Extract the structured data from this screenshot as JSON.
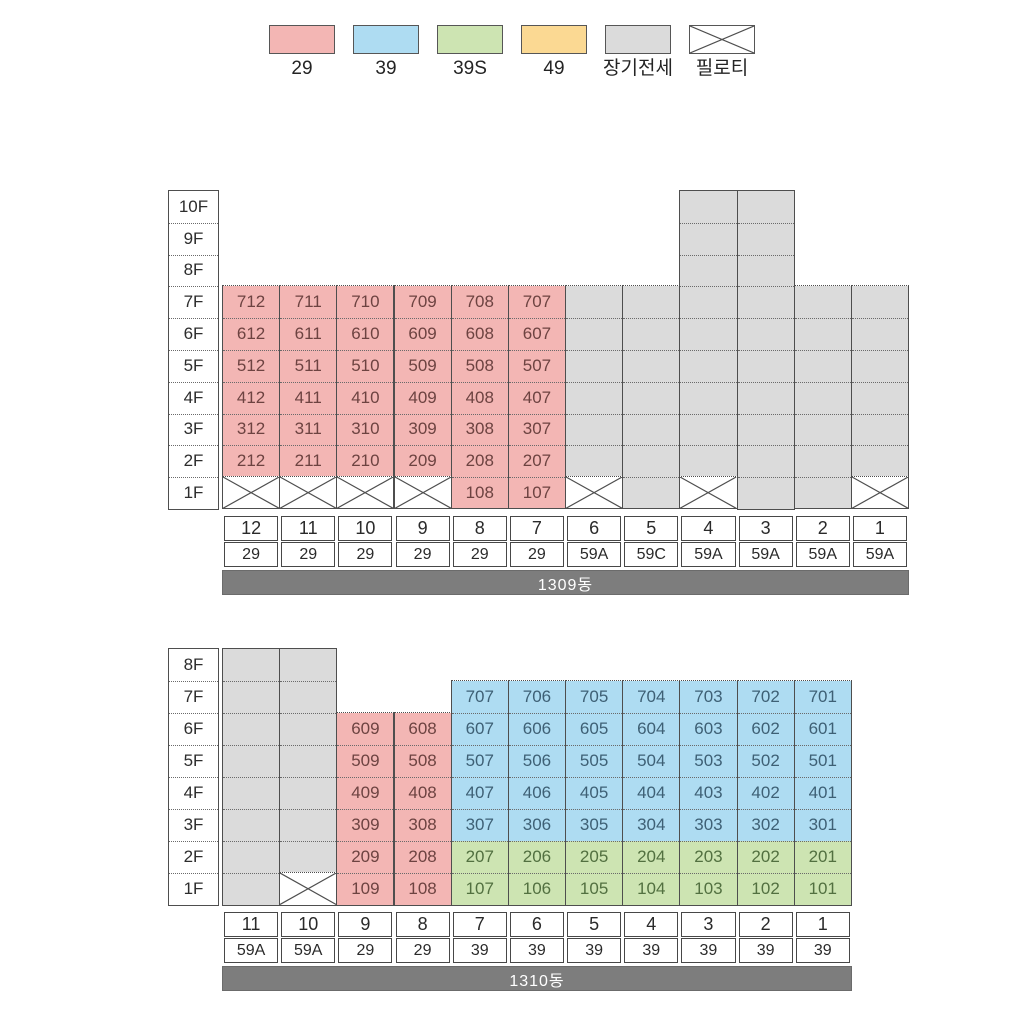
{
  "legend": {
    "items": [
      {
        "label": "29",
        "type": "29"
      },
      {
        "label": "39",
        "type": "39"
      },
      {
        "label": "39S",
        "type": "39S"
      },
      {
        "label": "49",
        "type": "49"
      },
      {
        "label": "장기전세",
        "type": "장기전세"
      },
      {
        "label": "필로티",
        "type": "필로티"
      }
    ]
  },
  "palette": {
    "fill": {
      "29": "#f3b6b4",
      "39": "#aedcf2",
      "39S": "#cde4b2",
      "49": "#fbd993",
      "장기전세": "#dbdbdb"
    },
    "text": {
      "29": "#6d4341",
      "39": "#3e6075",
      "39S": "#527040"
    },
    "pilotis_bg": "#ffffff",
    "border": "#4e4e4e",
    "bar_bg": "#7d7d7d",
    "bar_text": "#ffffff"
  },
  "cell_format": [
    "floor",
    "unit",
    "type"
  ],
  "buildings": [
    {
      "name": "1309동",
      "floors": [
        "10F",
        "9F",
        "8F",
        "7F",
        "6F",
        "5F",
        "4F",
        "3F",
        "2F",
        "1F"
      ],
      "columns": [
        {
          "line": "12",
          "unit_type": "29",
          "cells": [
            [
              "7F",
              "712",
              "29"
            ],
            [
              "6F",
              "612",
              "29"
            ],
            [
              "5F",
              "512",
              "29"
            ],
            [
              "4F",
              "412",
              "29"
            ],
            [
              "3F",
              "312",
              "29"
            ],
            [
              "2F",
              "212",
              "29"
            ],
            [
              "1F",
              "",
              "필로티"
            ]
          ]
        },
        {
          "line": "11",
          "unit_type": "29",
          "cells": [
            [
              "7F",
              "711",
              "29"
            ],
            [
              "6F",
              "611",
              "29"
            ],
            [
              "5F",
              "511",
              "29"
            ],
            [
              "4F",
              "411",
              "29"
            ],
            [
              "3F",
              "311",
              "29"
            ],
            [
              "2F",
              "211",
              "29"
            ],
            [
              "1F",
              "",
              "필로티"
            ]
          ]
        },
        {
          "line": "10",
          "unit_type": "29",
          "cells": [
            [
              "7F",
              "710",
              "29"
            ],
            [
              "6F",
              "610",
              "29"
            ],
            [
              "5F",
              "510",
              "29"
            ],
            [
              "4F",
              "410",
              "29"
            ],
            [
              "3F",
              "310",
              "29"
            ],
            [
              "2F",
              "210",
              "29"
            ],
            [
              "1F",
              "",
              "필로티"
            ]
          ]
        },
        {
          "line": "9",
          "unit_type": "29",
          "cells": [
            [
              "7F",
              "709",
              "29"
            ],
            [
              "6F",
              "609",
              "29"
            ],
            [
              "5F",
              "509",
              "29"
            ],
            [
              "4F",
              "409",
              "29"
            ],
            [
              "3F",
              "309",
              "29"
            ],
            [
              "2F",
              "209",
              "29"
            ],
            [
              "1F",
              "",
              "필로티"
            ]
          ]
        },
        {
          "line": "8",
          "unit_type": "29",
          "cells": [
            [
              "7F",
              "708",
              "29"
            ],
            [
              "6F",
              "608",
              "29"
            ],
            [
              "5F",
              "508",
              "29"
            ],
            [
              "4F",
              "408",
              "29"
            ],
            [
              "3F",
              "308",
              "29"
            ],
            [
              "2F",
              "208",
              "29"
            ],
            [
              "1F",
              "108",
              "29"
            ]
          ]
        },
        {
          "line": "7",
          "unit_type": "29",
          "cells": [
            [
              "7F",
              "707",
              "29"
            ],
            [
              "6F",
              "607",
              "29"
            ],
            [
              "5F",
              "507",
              "29"
            ],
            [
              "4F",
              "407",
              "29"
            ],
            [
              "3F",
              "307",
              "29"
            ],
            [
              "2F",
              "207",
              "29"
            ],
            [
              "1F",
              "107",
              "29"
            ]
          ]
        },
        {
          "line": "6",
          "unit_type": "59A",
          "cells": [
            [
              "7F",
              "",
              "장기전세"
            ],
            [
              "6F",
              "",
              "장기전세"
            ],
            [
              "5F",
              "",
              "장기전세"
            ],
            [
              "4F",
              "",
              "장기전세"
            ],
            [
              "3F",
              "",
              "장기전세"
            ],
            [
              "2F",
              "",
              "장기전세"
            ],
            [
              "1F",
              "",
              "필로티"
            ]
          ]
        },
        {
          "line": "5",
          "unit_type": "59C",
          "cells": [
            [
              "7F",
              "",
              "장기전세"
            ],
            [
              "6F",
              "",
              "장기전세"
            ],
            [
              "5F",
              "",
              "장기전세"
            ],
            [
              "4F",
              "",
              "장기전세"
            ],
            [
              "3F",
              "",
              "장기전세"
            ],
            [
              "2F",
              "",
              "장기전세"
            ],
            [
              "1F",
              "",
              "장기전세"
            ]
          ]
        },
        {
          "line": "4",
          "unit_type": "59A",
          "cells": [
            [
              "10F",
              "",
              "장기전세"
            ],
            [
              "9F",
              "",
              "장기전세"
            ],
            [
              "8F",
              "",
              "장기전세"
            ],
            [
              "7F",
              "",
              "장기전세"
            ],
            [
              "6F",
              "",
              "장기전세"
            ],
            [
              "5F",
              "",
              "장기전세"
            ],
            [
              "4F",
              "",
              "장기전세"
            ],
            [
              "3F",
              "",
              "장기전세"
            ],
            [
              "2F",
              "",
              "장기전세"
            ],
            [
              "1F",
              "",
              "필로티"
            ]
          ]
        },
        {
          "line": "3",
          "unit_type": "59A",
          "cells": [
            [
              "10F",
              "",
              "장기전세"
            ],
            [
              "9F",
              "",
              "장기전세"
            ],
            [
              "8F",
              "",
              "장기전세"
            ],
            [
              "7F",
              "",
              "장기전세"
            ],
            [
              "6F",
              "",
              "장기전세"
            ],
            [
              "5F",
              "",
              "장기전세"
            ],
            [
              "4F",
              "",
              "장기전세"
            ],
            [
              "3F",
              "",
              "장기전세"
            ],
            [
              "2F",
              "",
              "장기전세"
            ],
            [
              "1F",
              "",
              "장기전세"
            ]
          ]
        },
        {
          "line": "2",
          "unit_type": "59A",
          "cells": [
            [
              "7F",
              "",
              "장기전세"
            ],
            [
              "6F",
              "",
              "장기전세"
            ],
            [
              "5F",
              "",
              "장기전세"
            ],
            [
              "4F",
              "",
              "장기전세"
            ],
            [
              "3F",
              "",
              "장기전세"
            ],
            [
              "2F",
              "",
              "장기전세"
            ],
            [
              "1F",
              "",
              "장기전세"
            ]
          ]
        },
        {
          "line": "1",
          "unit_type": "59A",
          "cells": [
            [
              "7F",
              "",
              "장기전세"
            ],
            [
              "6F",
              "",
              "장기전세"
            ],
            [
              "5F",
              "",
              "장기전세"
            ],
            [
              "4F",
              "",
              "장기전세"
            ],
            [
              "3F",
              "",
              "장기전세"
            ],
            [
              "2F",
              "",
              "장기전세"
            ],
            [
              "1F",
              "",
              "필로티"
            ]
          ]
        }
      ]
    },
    {
      "name": "1310동",
      "floors": [
        "8F",
        "7F",
        "6F",
        "5F",
        "4F",
        "3F",
        "2F",
        "1F"
      ],
      "columns": [
        {
          "line": "11",
          "unit_type": "59A",
          "cells": [
            [
              "8F",
              "",
              "장기전세"
            ],
            [
              "7F",
              "",
              "장기전세"
            ],
            [
              "6F",
              "",
              "장기전세"
            ],
            [
              "5F",
              "",
              "장기전세"
            ],
            [
              "4F",
              "",
              "장기전세"
            ],
            [
              "3F",
              "",
              "장기전세"
            ],
            [
              "2F",
              "",
              "장기전세"
            ],
            [
              "1F",
              "",
              "장기전세"
            ]
          ]
        },
        {
          "line": "10",
          "unit_type": "59A",
          "cells": [
            [
              "8F",
              "",
              "장기전세"
            ],
            [
              "7F",
              "",
              "장기전세"
            ],
            [
              "6F",
              "",
              "장기전세"
            ],
            [
              "5F",
              "",
              "장기전세"
            ],
            [
              "4F",
              "",
              "장기전세"
            ],
            [
              "3F",
              "",
              "장기전세"
            ],
            [
              "2F",
              "",
              "장기전세"
            ],
            [
              "1F",
              "",
              "필로티"
            ]
          ]
        },
        {
          "line": "9",
          "unit_type": "29",
          "cells": [
            [
              "6F",
              "609",
              "29"
            ],
            [
              "5F",
              "509",
              "29"
            ],
            [
              "4F",
              "409",
              "29"
            ],
            [
              "3F",
              "309",
              "29"
            ],
            [
              "2F",
              "209",
              "29"
            ],
            [
              "1F",
              "109",
              "29"
            ]
          ]
        },
        {
          "line": "8",
          "unit_type": "29",
          "cells": [
            [
              "6F",
              "608",
              "29"
            ],
            [
              "5F",
              "508",
              "29"
            ],
            [
              "4F",
              "408",
              "29"
            ],
            [
              "3F",
              "308",
              "29"
            ],
            [
              "2F",
              "208",
              "29"
            ],
            [
              "1F",
              "108",
              "29"
            ]
          ]
        },
        {
          "line": "7",
          "unit_type": "39",
          "cells": [
            [
              "7F",
              "707",
              "39"
            ],
            [
              "6F",
              "607",
              "39"
            ],
            [
              "5F",
              "507",
              "39"
            ],
            [
              "4F",
              "407",
              "39"
            ],
            [
              "3F",
              "307",
              "39"
            ],
            [
              "2F",
              "207",
              "39S"
            ],
            [
              "1F",
              "107",
              "39S"
            ]
          ]
        },
        {
          "line": "6",
          "unit_type": "39",
          "cells": [
            [
              "7F",
              "706",
              "39"
            ],
            [
              "6F",
              "606",
              "39"
            ],
            [
              "5F",
              "506",
              "39"
            ],
            [
              "4F",
              "406",
              "39"
            ],
            [
              "3F",
              "306",
              "39"
            ],
            [
              "2F",
              "206",
              "39S"
            ],
            [
              "1F",
              "106",
              "39S"
            ]
          ]
        },
        {
          "line": "5",
          "unit_type": "39",
          "cells": [
            [
              "7F",
              "705",
              "39"
            ],
            [
              "6F",
              "605",
              "39"
            ],
            [
              "5F",
              "505",
              "39"
            ],
            [
              "4F",
              "405",
              "39"
            ],
            [
              "3F",
              "305",
              "39"
            ],
            [
              "2F",
              "205",
              "39S"
            ],
            [
              "1F",
              "105",
              "39S"
            ]
          ]
        },
        {
          "line": "4",
          "unit_type": "39",
          "cells": [
            [
              "7F",
              "704",
              "39"
            ],
            [
              "6F",
              "604",
              "39"
            ],
            [
              "5F",
              "504",
              "39"
            ],
            [
              "4F",
              "404",
              "39"
            ],
            [
              "3F",
              "304",
              "39"
            ],
            [
              "2F",
              "204",
              "39S"
            ],
            [
              "1F",
              "104",
              "39S"
            ]
          ]
        },
        {
          "line": "3",
          "unit_type": "39",
          "cells": [
            [
              "7F",
              "703",
              "39"
            ],
            [
              "6F",
              "603",
              "39"
            ],
            [
              "5F",
              "503",
              "39"
            ],
            [
              "4F",
              "403",
              "39"
            ],
            [
              "3F",
              "303",
              "39"
            ],
            [
              "2F",
              "203",
              "39S"
            ],
            [
              "1F",
              "103",
              "39S"
            ]
          ]
        },
        {
          "line": "2",
          "unit_type": "39",
          "cells": [
            [
              "7F",
              "702",
              "39"
            ],
            [
              "6F",
              "602",
              "39"
            ],
            [
              "5F",
              "502",
              "39"
            ],
            [
              "4F",
              "402",
              "39"
            ],
            [
              "3F",
              "302",
              "39"
            ],
            [
              "2F",
              "202",
              "39S"
            ],
            [
              "1F",
              "102",
              "39S"
            ]
          ]
        },
        {
          "line": "1",
          "unit_type": "39",
          "cells": [
            [
              "7F",
              "701",
              "39"
            ],
            [
              "6F",
              "601",
              "39"
            ],
            [
              "5F",
              "501",
              "39"
            ],
            [
              "4F",
              "401",
              "39"
            ],
            [
              "3F",
              "301",
              "39"
            ],
            [
              "2F",
              "201",
              "39S"
            ],
            [
              "1F",
              "101",
              "39S"
            ]
          ]
        }
      ]
    }
  ]
}
